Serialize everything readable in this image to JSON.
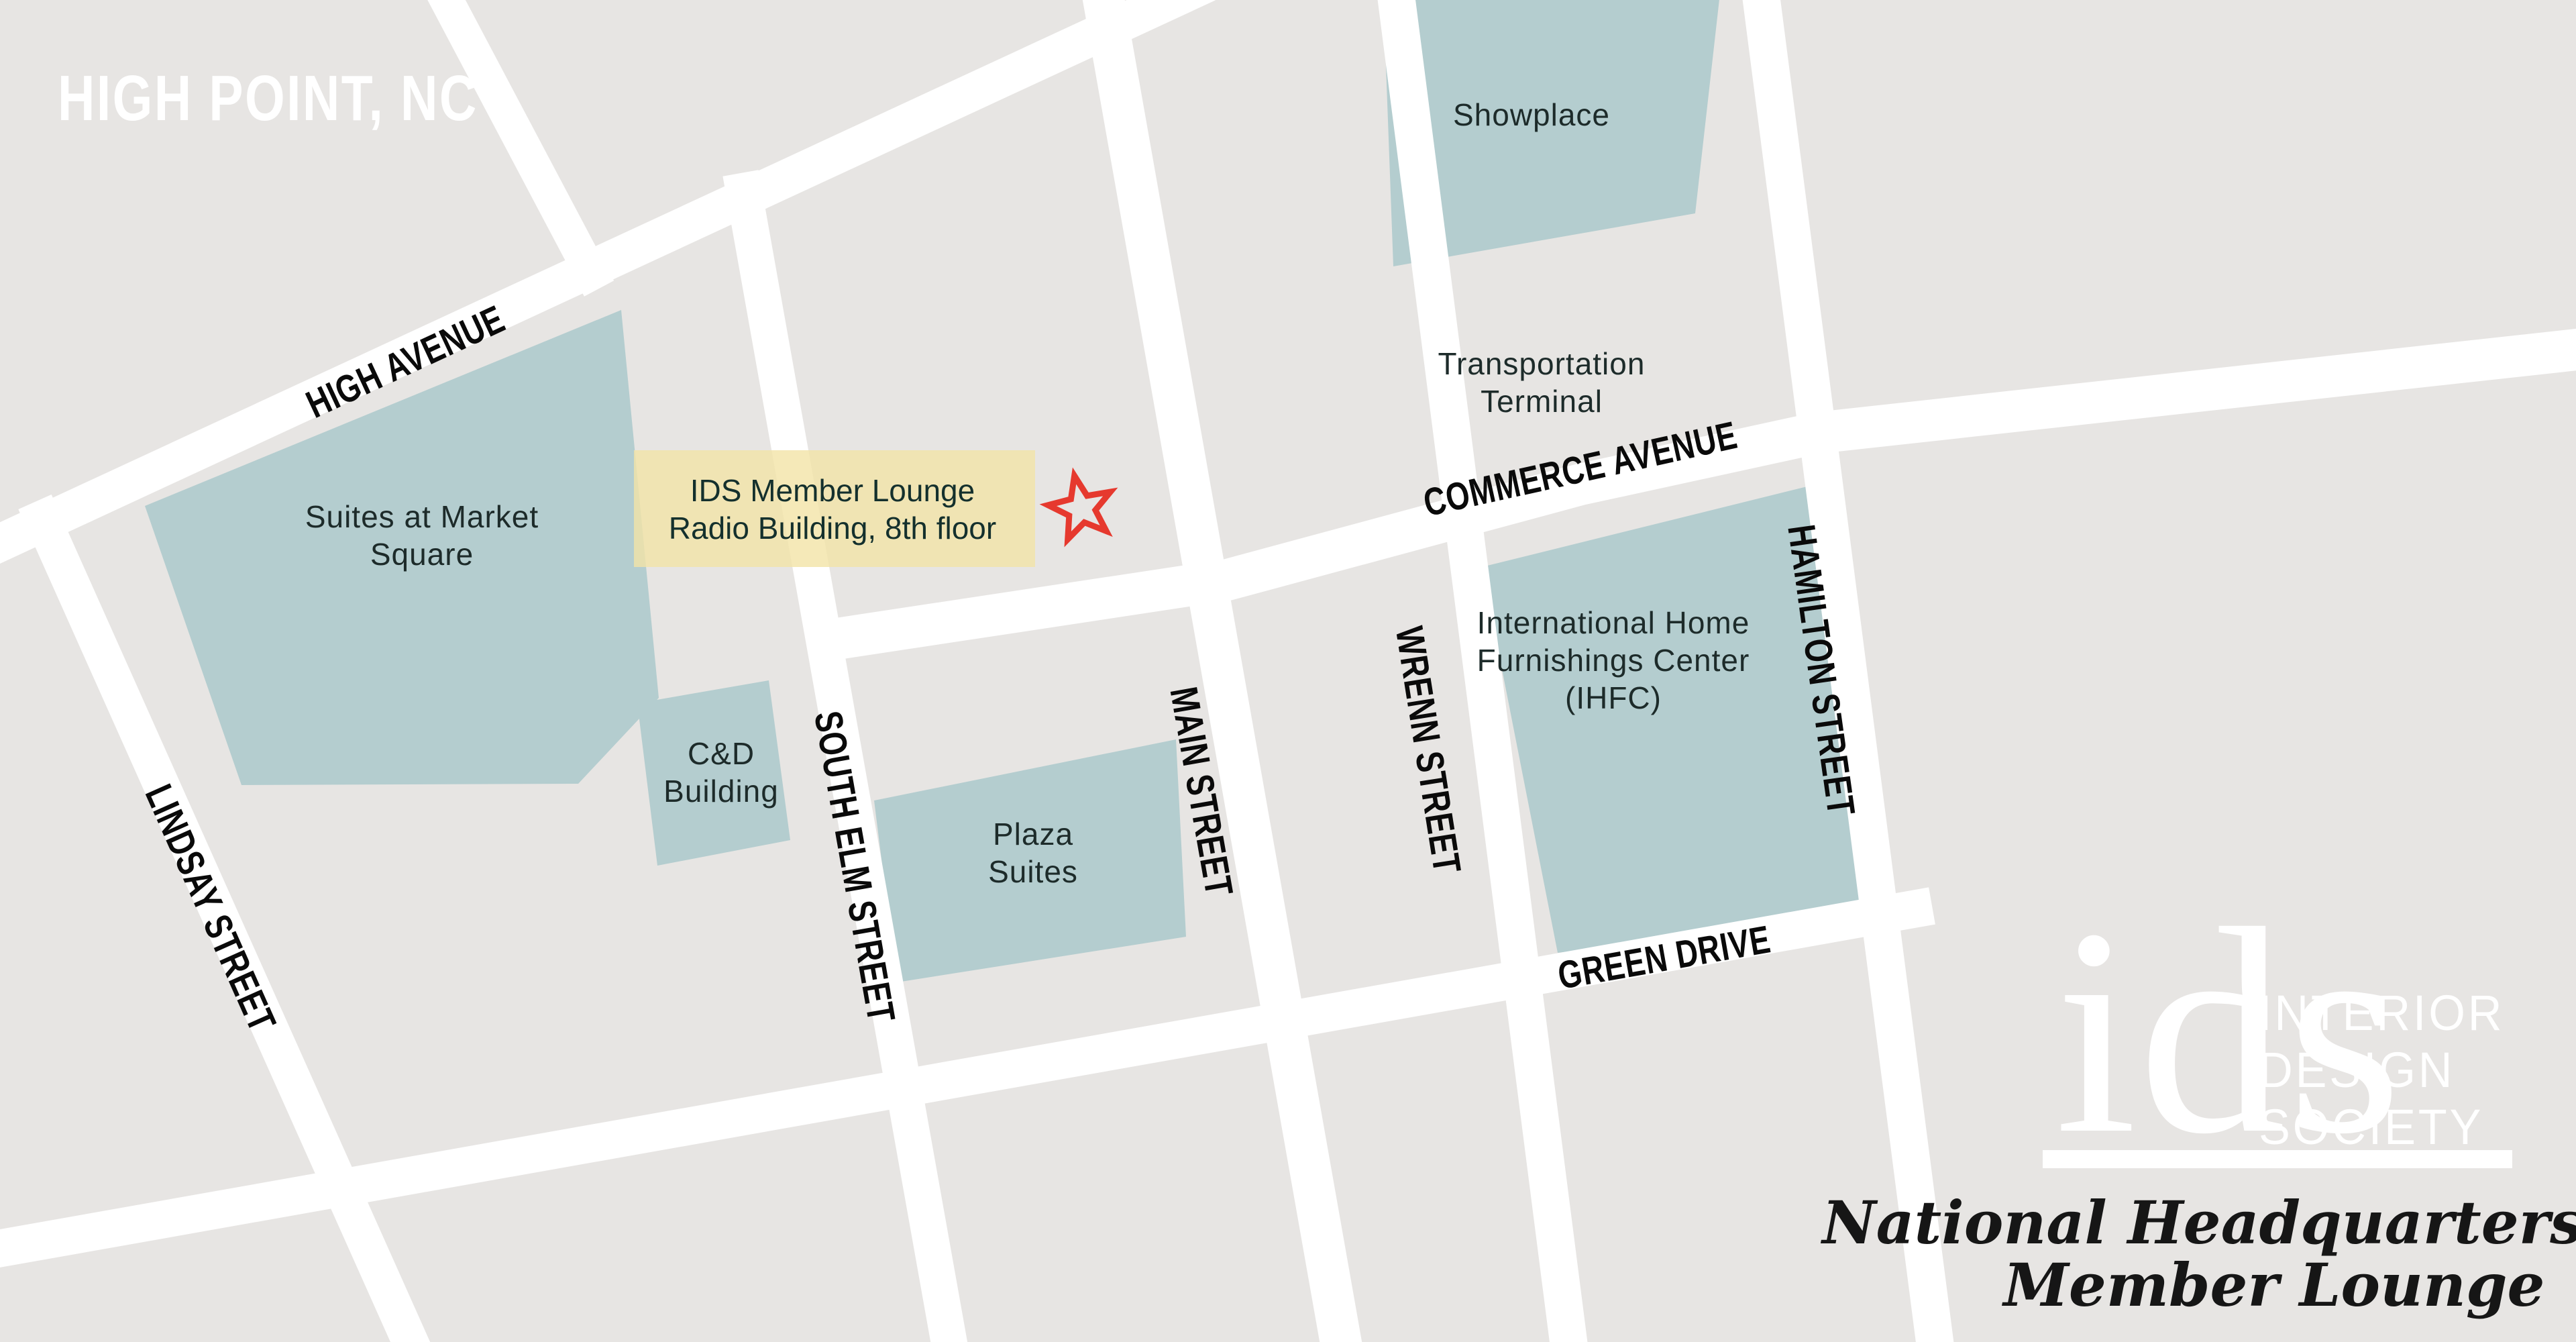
{
  "title": "HIGH POINT, NC",
  "streets": {
    "high_avenue": "HIGH AVENUE",
    "lindsay": "LINDSAY STREET",
    "south_elm": "SOUTH ELM STREET",
    "main": "MAIN STREET",
    "wrenn": "WRENN STREET",
    "hamilton": "HAMILTON STREET",
    "commerce": "COMMERCE AVENUE",
    "green_drive": "GREEN DRIVE"
  },
  "buildings": {
    "showplace": {
      "line1": "Showplace"
    },
    "suites_at_market_square": {
      "line1": "Suites at Market",
      "line2": "Square"
    },
    "cd_building": {
      "line1": "C&D",
      "line2": "Building"
    },
    "plaza_suites": {
      "line1": "Plaza",
      "line2": "Suites"
    },
    "ihfc": {
      "line1": "International Home",
      "line2": "Furnishings Center",
      "line3": "(IHFC)"
    },
    "transportation_terminal": {
      "line1": "Transportation",
      "line2": "Terminal"
    }
  },
  "marker": {
    "line1": "IDS Member Lounge",
    "line2": "Radio Building, 8th floor",
    "icon": "star-outline-icon",
    "star_color": "#e6392e",
    "highlight_color": "#f3e3a6"
  },
  "logo": {
    "mark": "ids",
    "org_lines": [
      "INTERIOR",
      "DESIGN",
      "SOCIETY"
    ],
    "tagline_line1": "National Headquarters and",
    "tagline_line2": "Member Lounge"
  },
  "colors": {
    "background": "#e7e5e3",
    "street": "#ffffff",
    "building_fill": "#b4cdcf",
    "street_text": "#0a0a0a",
    "building_text": "#1d2b2a",
    "title_text": "#ffffff"
  }
}
